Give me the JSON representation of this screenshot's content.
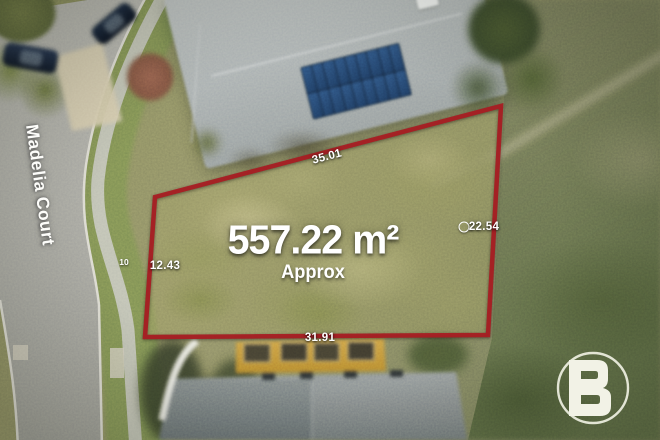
{
  "street": {
    "name": "Madelia Court"
  },
  "lot": {
    "area": "557.22 m²",
    "area_qualifier": "Approx",
    "dimensions": {
      "top": "35.01",
      "right": "22.54",
      "bottom": "31.91",
      "left": "12.43",
      "left_marker": "10"
    },
    "right_dimension_marker_icon": "circle-marker-icon"
  },
  "branding": {
    "logo_letter": "B"
  },
  "colors": {
    "boundary": "#a81e23",
    "label_text": "#ffffff",
    "logo": "#f2f2e6"
  }
}
